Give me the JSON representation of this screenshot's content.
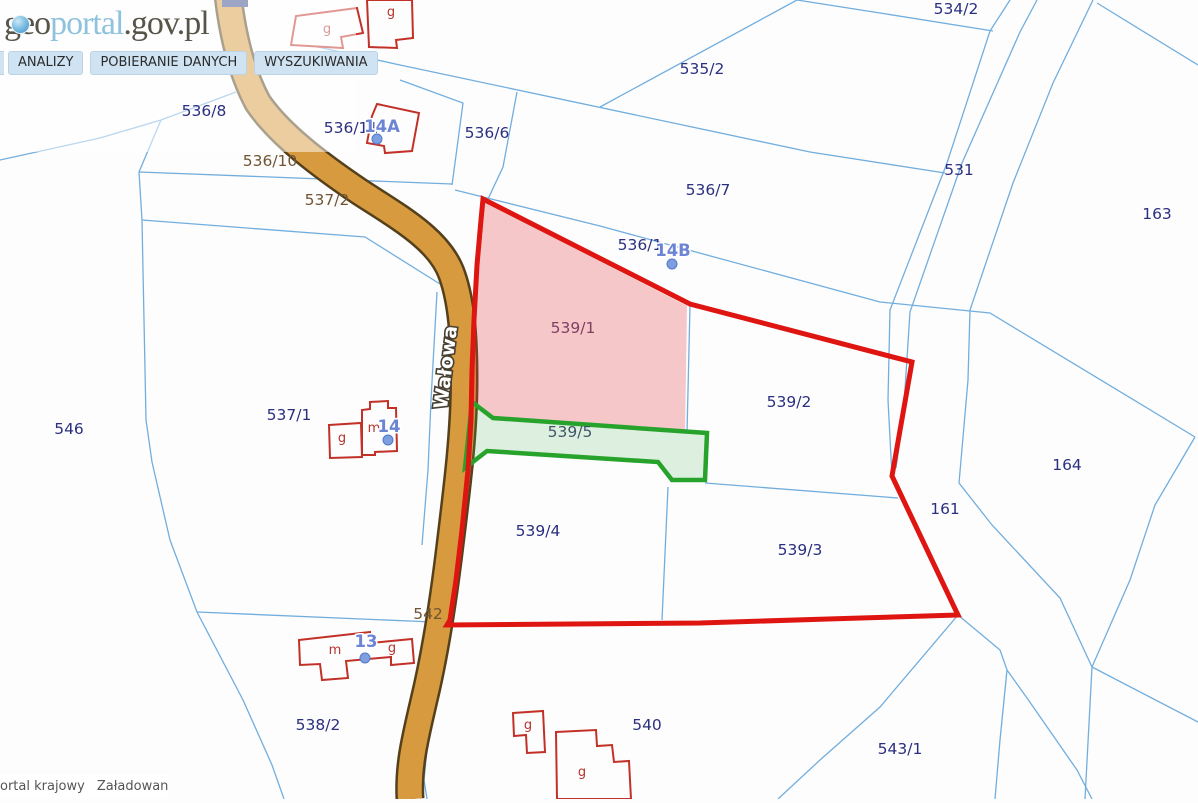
{
  "logo": {
    "part_geo": "geo",
    "part_portal": "portal",
    "part_tail": ".gov.pl"
  },
  "menu": {
    "items": [
      {
        "label": "ANALIZY"
      },
      {
        "label": "POBIERANIE DANYCH"
      },
      {
        "label": "WYSZUKIWANIA"
      }
    ]
  },
  "status_bar": {
    "left_text": "ortal krajowy",
    "right_text": "Załadowano"
  },
  "street": {
    "name": "Wałowa"
  },
  "colors": {
    "parcel_line": "#72aedd",
    "parcel_label": "#2b2f7f",
    "road_label": "#6f5531",
    "pink_label": "#7e4063",
    "green_area_label": "#3f5668",
    "address_label": "#6c84d4",
    "building_outline": "#c23127",
    "building_letter": "#b5342c",
    "road_fill": "#d79a3e",
    "road_border": "#55401c",
    "red_boundary": "#de1510",
    "green_boundary": "#27a32c",
    "pink_fill": "rgba(225,60,60,0.28)",
    "green_fill": "rgba(76,175,80,0.18)",
    "dot_fill": "#7b9fe0",
    "dot_stroke": "#5577c8"
  },
  "map": {
    "parcel_labels": [
      {
        "text": "534/2",
        "x": 956,
        "y": 14,
        "kind": "parcel"
      },
      {
        "text": "535/2",
        "x": 702,
        "y": 74,
        "kind": "parcel"
      },
      {
        "text": "531",
        "x": 959,
        "y": 175,
        "kind": "parcel"
      },
      {
        "text": "536/7",
        "x": 708,
        "y": 195,
        "kind": "parcel"
      },
      {
        "text": "163",
        "x": 1157,
        "y": 219,
        "kind": "parcel"
      },
      {
        "text": "536/8",
        "x": 204,
        "y": 116,
        "kind": "parcel"
      },
      {
        "text": "536/11",
        "x": 351,
        "y": 133,
        "kind": "parcel"
      },
      {
        "text": "536/6",
        "x": 487,
        "y": 138,
        "kind": "parcel"
      },
      {
        "text": "536/10",
        "x": 270,
        "y": 166,
        "kind": "road"
      },
      {
        "text": "537/2",
        "x": 327,
        "y": 205,
        "kind": "road"
      },
      {
        "text": "536/1",
        "x": 640,
        "y": 250,
        "kind": "parcel"
      },
      {
        "text": "539/1",
        "x": 573,
        "y": 333,
        "kind": "pink"
      },
      {
        "text": "539/2",
        "x": 789,
        "y": 407,
        "kind": "parcel"
      },
      {
        "text": "537/1",
        "x": 289,
        "y": 420,
        "kind": "parcel"
      },
      {
        "text": "546",
        "x": 69,
        "y": 434,
        "kind": "parcel"
      },
      {
        "text": "539/5",
        "x": 570,
        "y": 437,
        "kind": "green"
      },
      {
        "text": "164",
        "x": 1067,
        "y": 470,
        "kind": "parcel"
      },
      {
        "text": "161",
        "x": 945,
        "y": 514,
        "kind": "parcel"
      },
      {
        "text": "539/4",
        "x": 538,
        "y": 536,
        "kind": "parcel"
      },
      {
        "text": "539/3",
        "x": 800,
        "y": 555,
        "kind": "parcel"
      },
      {
        "text": "542",
        "x": 428,
        "y": 619,
        "kind": "road"
      },
      {
        "text": "538/2",
        "x": 318,
        "y": 730,
        "kind": "parcel"
      },
      {
        "text": "540",
        "x": 647,
        "y": 730,
        "kind": "parcel"
      },
      {
        "text": "543/1",
        "x": 900,
        "y": 754,
        "kind": "parcel"
      }
    ],
    "address_labels": [
      {
        "text": "14A",
        "x": 382,
        "y": 132
      },
      {
        "text": "14B",
        "x": 673,
        "y": 256
      },
      {
        "text": "14",
        "x": 389,
        "y": 432
      },
      {
        "text": "13",
        "x": 366,
        "y": 647
      }
    ],
    "address_dots": [
      {
        "x": 377,
        "y": 139
      },
      {
        "x": 672,
        "y": 264
      },
      {
        "x": 388,
        "y": 440
      },
      {
        "x": 365,
        "y": 658
      }
    ],
    "building_letters": [
      {
        "text": "g",
        "x": 327,
        "y": 33
      },
      {
        "text": "g",
        "x": 391,
        "y": 16
      },
      {
        "text": "g",
        "x": 342,
        "y": 442
      },
      {
        "text": "m",
        "x": 374,
        "y": 432
      },
      {
        "text": "m",
        "x": 335,
        "y": 654
      },
      {
        "text": "g",
        "x": 392,
        "y": 652
      },
      {
        "text": "g",
        "x": 528,
        "y": 729
      },
      {
        "text": "g",
        "x": 582,
        "y": 776
      }
    ],
    "parcel_lines": [
      "M0,160 L100,138 L161,120 L236,92",
      "M161,120 L139,172 L142,220 L146,420 L152,462 L170,540 L197,612 L243,700 L272,765 L284,799",
      "M139,172 L452,184",
      "M142,220 L365,237 L440,284",
      "M197,612 L433,622",
      "M318,47 L400,65 L810,152 L945,173",
      "M600,107 L797,0",
      "M797,0 L880,13 L993,31",
      "M400,80 L463,103 L455,163 L452,185",
      "M517,92 L503,167 L488,199",
      "M455,190 L600,226 L880,302 L990,313 L1195,437",
      "M690,306 L687,433",
      "M705,483 L898,498",
      "M668,487 L662,620",
      "M1010,0 L990,31 L947,163 L890,310 L888,400 L892,476",
      "M1037,0 L1020,32 L962,163 L910,312 L903,420 L896,468",
      "M1093,0 L1053,83 L1013,183 L970,310 L968,380 L959,483 L992,525 L1060,598 L1092,667",
      "M1097,3 L1198,65",
      "M1195,437 L1155,505 L1130,580 L1092,667",
      "M1092,667 L1085,799",
      "M1092,667 L1198,722",
      "M958,615 L880,707 L820,760 L778,799",
      "M958,615 L1000,650 L1007,670 L1027,698 L1077,770 L1092,799",
      "M1007,670 L1000,740 L995,799",
      "M437,292 L431,400 L428,470 L422,545",
      "M450,628 L438,690 L428,740 L424,780 L427,799"
    ],
    "road": {
      "path": "M228,-5 C232,30 240,70 258,103 C280,135 320,165 360,192 C400,218 440,240 452,275 C462,303 464,340 464,380 C464,430 458,480 450,545 C444,595 436,650 424,700 C416,735 408,765 410,799",
      "cap_rect": {
        "x": 222,
        "y": 0,
        "w": 26,
        "h": 7,
        "color": "#3a4a8c"
      }
    },
    "highlights": {
      "pink_polygon": "483,201 687,306 685,432 493,419 473,403 474,360 476,310 479,250 482,210",
      "green_polygon": "472,402 493,418 707,433 705,480 672,480 658,462 487,451 465,468",
      "red_polygon": "483,199 690,304 912,362 892,476 958,615 828,619 700,623 447,625 450,620 456,580 462,530 468,470 471,420 472,370 474,320 477,265 481,220"
    },
    "buildings": [
      "M291,45 L296,16 L357,8 L363,33 L341,37 L343,48 Z",
      "M369,47 L367,0 L412,0 L413,38 L396,40 L397,48 Z",
      "M377,104 L419,113 L412,151 L385,153 L384,146 L367,143 L372,116 Z",
      "M329,425 L361,423 L362,457 L330,458 Z",
      "M362,424 L362,410 L370,409 L370,402 L388,401 L388,408 L396,408 L397,451 L375,452 L375,455 L362,455 Z",
      "M299,640 L370,632 L371,643 L412,639 L414,663 L391,665 L391,657 L346,661 L348,678 L322,680 L320,664 L300,665 Z",
      "M513,713 L543,711 L545,752 L527,753 L526,735 L514,736 Z",
      "M556,732 L596,730 L597,746 L612,745 L614,762 L629,761 L631,799 L557,799 Z"
    ],
    "street_label": {
      "x": 452,
      "y": 368,
      "rotation": -83
    }
  }
}
